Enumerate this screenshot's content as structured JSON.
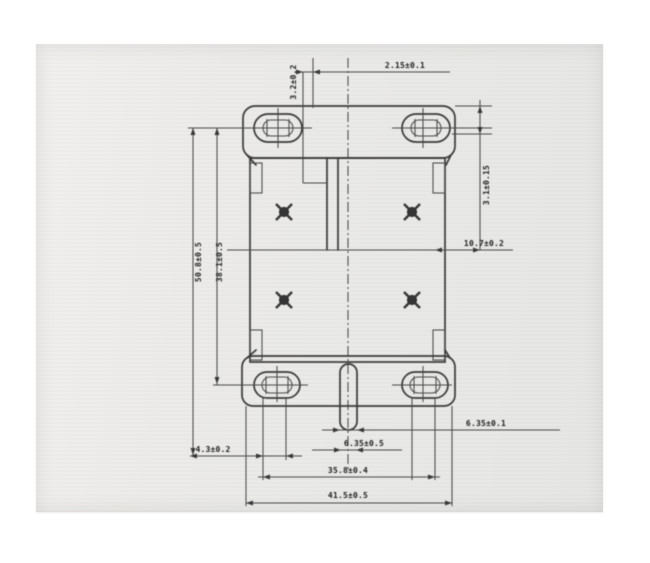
{
  "page": {
    "kind": "scanned technical drawing",
    "paper_color": "#ebebe9",
    "line_color": "#3a3a3a",
    "text_color": "#222222"
  },
  "drawing": {
    "description": "mounting bracket, front view: top and bottom flanges with double-outline slotted holes, body with four cross-marked holes, center ground tab, dashed vertical centerline",
    "labels": {
      "top_dim": "2.15±0.1",
      "top_offset": "3.2±0.2",
      "right_side_vertical": "3.1±0.15",
      "right_mid": "10.7±0.2",
      "left_outer": "50.8±0.5",
      "left_inner": "38.1±0.5",
      "tab_right": "6.35±0.1",
      "tab_center": "6.35±0.5",
      "bottom_left": "4.3±0.2",
      "slot_span": "35.8±0.4",
      "overall_width": "41.5±0.5"
    }
  }
}
